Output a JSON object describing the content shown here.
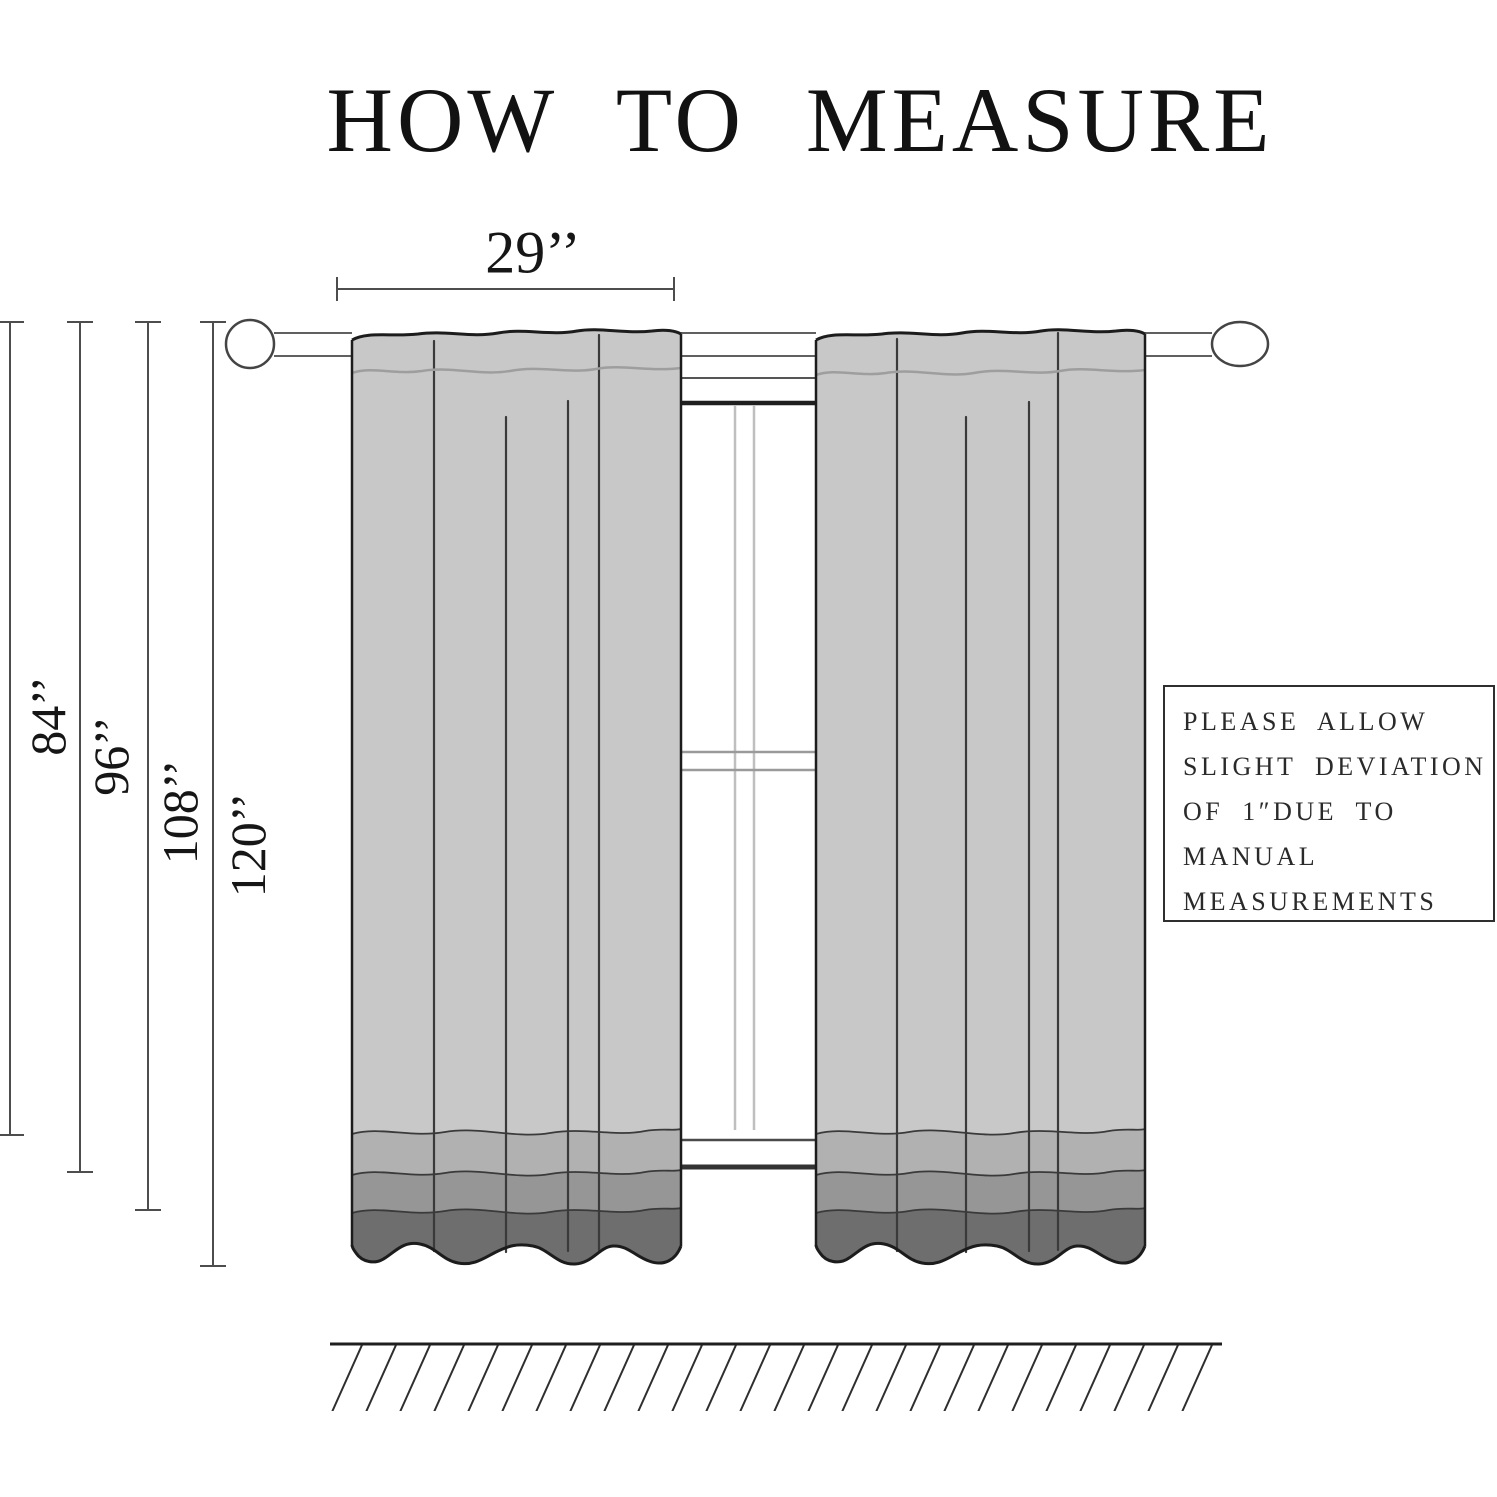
{
  "title": "HOW TO MEASURE",
  "measurements": {
    "panel_width_label": "29’’",
    "length_labels": [
      "84’’",
      "96’’",
      "108’’",
      "120’’"
    ]
  },
  "note_box": {
    "lines": [
      "PLEASE ALLOW",
      "SLIGHT DEVIATION",
      "OF 1″DUE TO",
      "MANUAL",
      "MEASUREMENTS"
    ]
  },
  "colors": {
    "curtain_body": "#c8c8c8",
    "curtain_band_2": "#b1b1b1",
    "curtain_band_3": "#969696",
    "curtain_band_4": "#6e6e6e",
    "outline": "#1c1c1c",
    "measure_line": "#4d4d4d"
  }
}
